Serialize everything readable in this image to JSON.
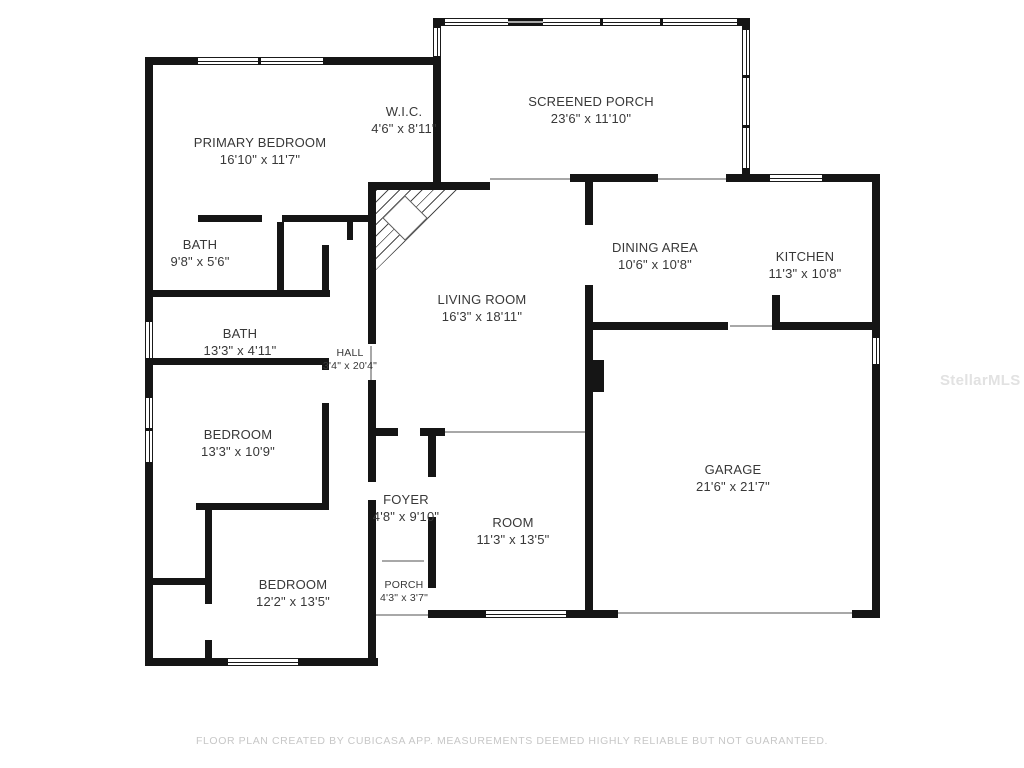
{
  "plan": {
    "rooms": [
      {
        "name": "PRIMARY BEDROOM",
        "dims": "16'10\" x 11'7\""
      },
      {
        "name": "W.I.C.",
        "dims": "4'6\" x 8'11\""
      },
      {
        "name": "SCREENED PORCH",
        "dims": "23'6\" x 11'10\""
      },
      {
        "name": "DINING AREA",
        "dims": "10'6\" x 10'8\""
      },
      {
        "name": "KITCHEN",
        "dims": "11'3\" x 10'8\""
      },
      {
        "name": "LIVING ROOM",
        "dims": "16'3\" x 18'11\""
      },
      {
        "name": "BATH",
        "dims": "9'8\" x 5'6\""
      },
      {
        "name": "BATH",
        "dims": "13'3\" x 4'11\""
      },
      {
        "name": "HALL",
        "dims": "3'4\" x 20'4\""
      },
      {
        "name": "BEDROOM",
        "dims": "13'3\" x 10'9\""
      },
      {
        "name": "FOYER",
        "dims": "4'8\" x 9'10\""
      },
      {
        "name": "ROOM",
        "dims": "11'3\" x 13'5\""
      },
      {
        "name": "PORCH",
        "dims": "4'3\" x 3'7\""
      },
      {
        "name": "BEDROOM",
        "dims": "12'2\" x 13'5\""
      },
      {
        "name": "GARAGE",
        "dims": "21'6\" x 21'7\""
      }
    ],
    "watermark": "StellarMLS",
    "footer": "FLOOR PLAN CREATED BY CUBICASA APP. MEASUREMENTS DEEMED HIGHLY RELIABLE BUT NOT GUARANTEED.",
    "colors": {
      "wall": "#151515",
      "label": "#383838",
      "footer": "#c7c7c7",
      "watermark": "#e2e2e2"
    }
  }
}
